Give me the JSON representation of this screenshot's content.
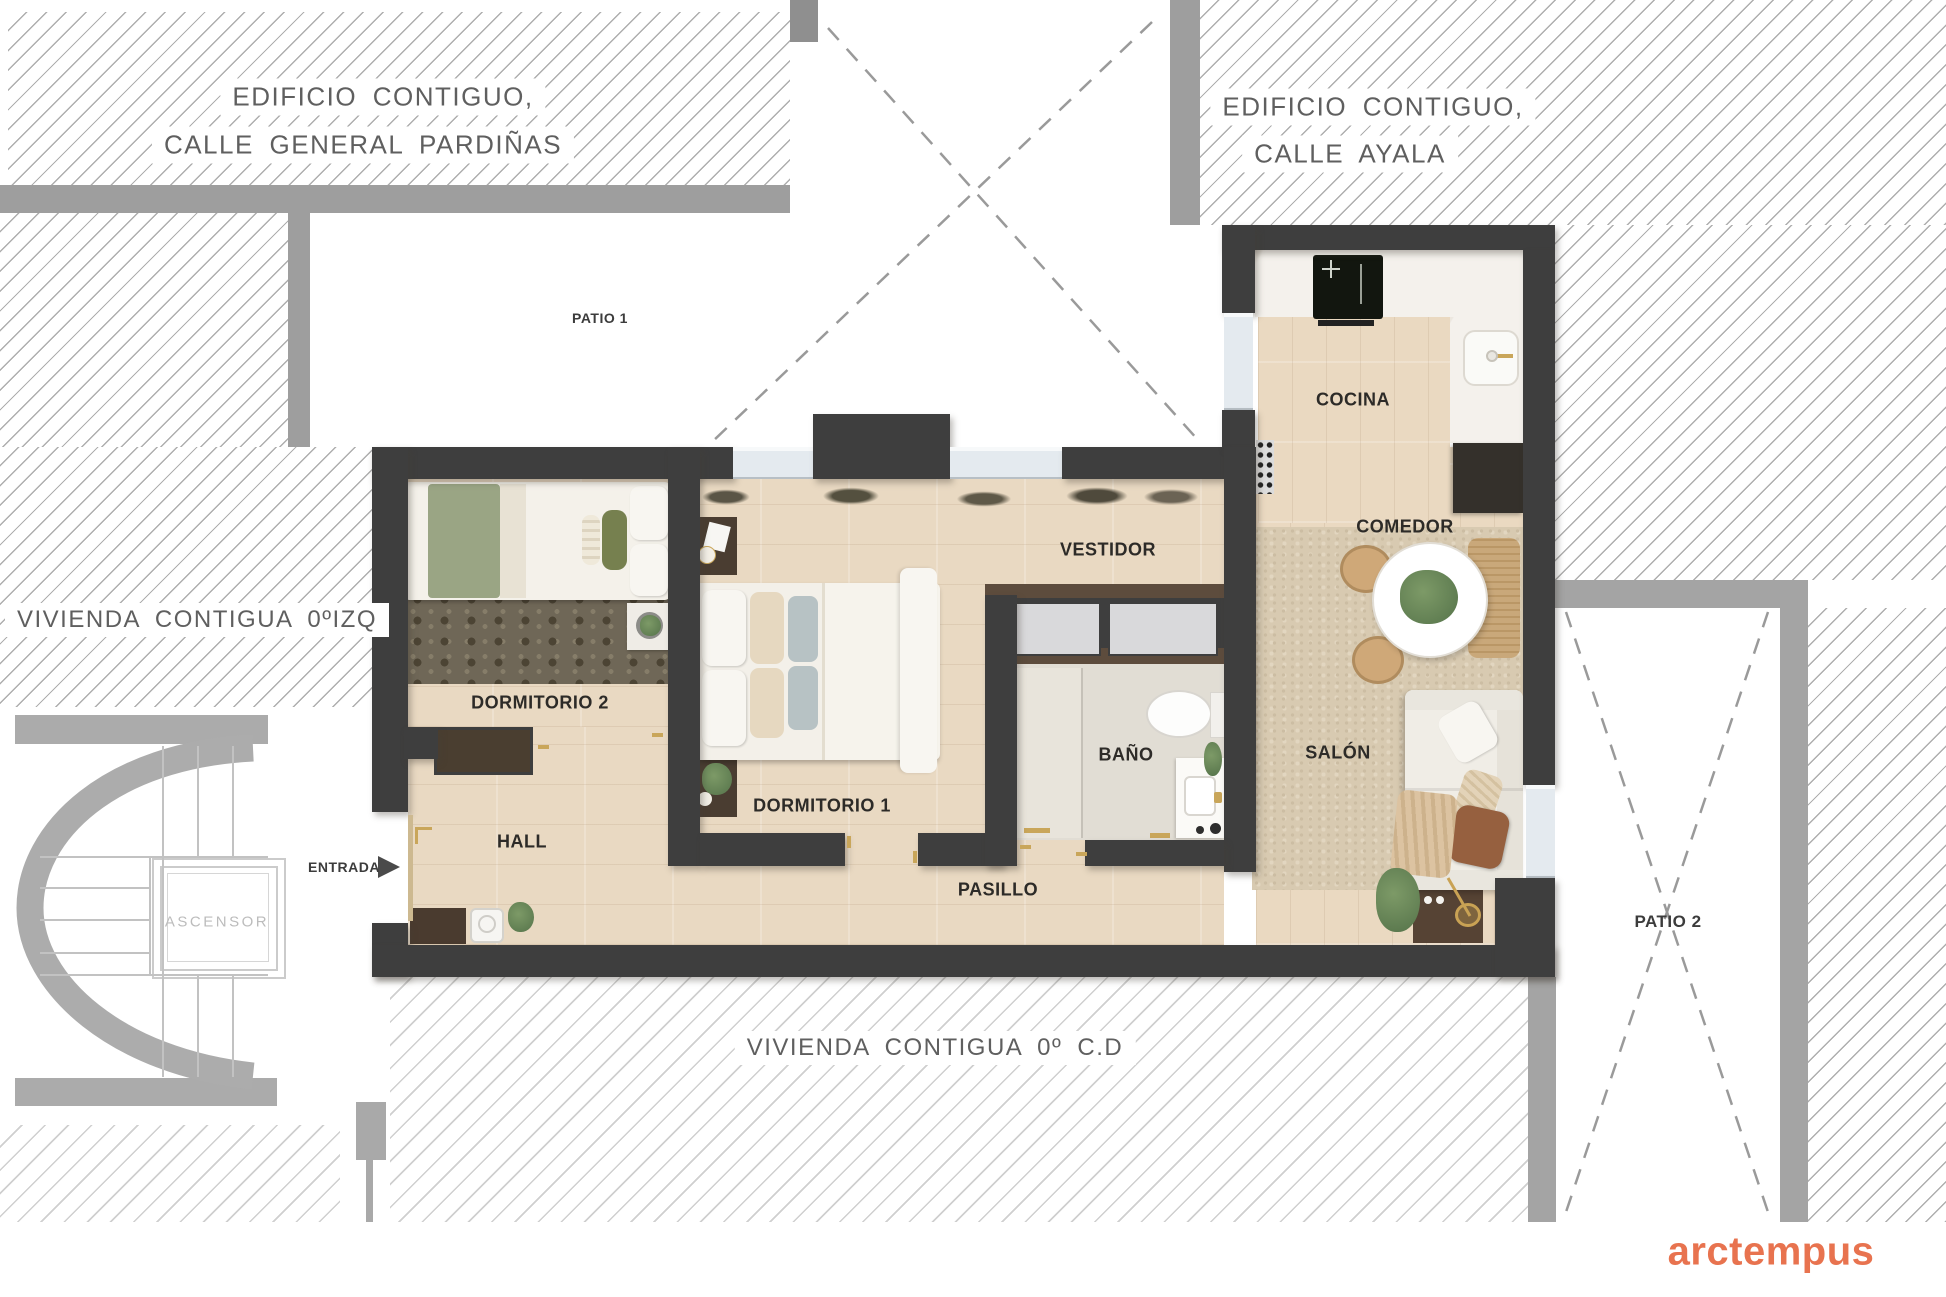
{
  "neighbors": {
    "top_left": {
      "line1": "EDIFICIO  CONTIGUO,",
      "line2": "CALLE GENERAL PARDIÑAS"
    },
    "top_right": {
      "line1": "EDIFICIO  CONTIGUO,",
      "line2": "CALLE AYALA"
    },
    "left": {
      "label": "VIVIENDA CONTIGUA 0ºIZQ"
    },
    "bottom": {
      "label": "VIVIENDA  CONTIGUA    0º   C.D"
    }
  },
  "patios": {
    "patio1": {
      "label": "PATIO 1"
    },
    "patio2": {
      "label": "PATIO 2"
    }
  },
  "rooms": {
    "cocina": {
      "label": "COCINA"
    },
    "comedor": {
      "label": "COMEDOR"
    },
    "salon": {
      "label": "SALÓN"
    },
    "vestidor": {
      "label": "VESTIDOR"
    },
    "bano": {
      "label": "BAÑO"
    },
    "pasillo": {
      "label": "PASILLO"
    },
    "hall": {
      "label": "HALL"
    },
    "dormitorio1": {
      "label": "DORMITORIO 1"
    },
    "dormitorio2": {
      "label": "DORMITORIO 2"
    }
  },
  "common": {
    "entrada": "ENTRADA",
    "ascensor": "ASCENSOR"
  },
  "logo": {
    "text": "arctempus",
    "color": "#E8734F"
  },
  "colors": {
    "wall": "#3E3E3E",
    "hatch_line": "#AEAEAE",
    "gray_band": "#9E9E9E",
    "wood": "#E9D9C2",
    "carpet": "#6F6757",
    "rug": "#D8CAB1",
    "accent_gold": "#C9A65A",
    "logo_coral": "#E8734F"
  }
}
